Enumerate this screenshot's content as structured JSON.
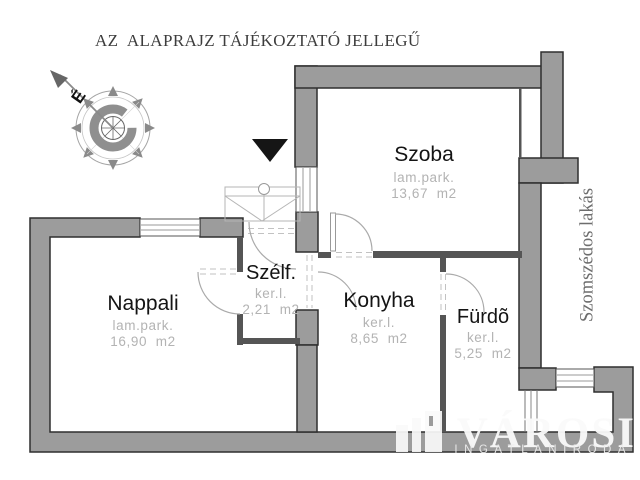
{
  "header": {
    "title": "AZ  ALAPRAJZ TÁJÉKOZTATÓ JELLEGŰ"
  },
  "compass": {
    "north_label": "É"
  },
  "rooms": [
    {
      "name": "Szoba",
      "floor": "lam.park.",
      "area": "13,67  m2"
    },
    {
      "name": "Nappali",
      "floor": "lam.park.",
      "area": "16,90  m2"
    },
    {
      "name": "Szélf.",
      "floor": "ker.l.",
      "area": "2,21  m2"
    },
    {
      "name": "Konyha",
      "floor": "ker.l.",
      "area": "8,65  m2"
    },
    {
      "name": "Fürdõ",
      "floor": "ker.l.",
      "area": "5,25  m2"
    }
  ],
  "labels": {
    "neighbor": "Szomszédos lakás"
  },
  "watermark": {
    "brand": "VÁROSI",
    "subtitle": "INGATLANIRODA"
  },
  "colors": {
    "wall_fill": "#9c9c9c",
    "wall_outline": "#2e2e2e",
    "partition": "#555555",
    "room_sub_text": "#b3b3b3",
    "room_name_text": "#141414",
    "neighbor_text": "#6d6d6d"
  }
}
